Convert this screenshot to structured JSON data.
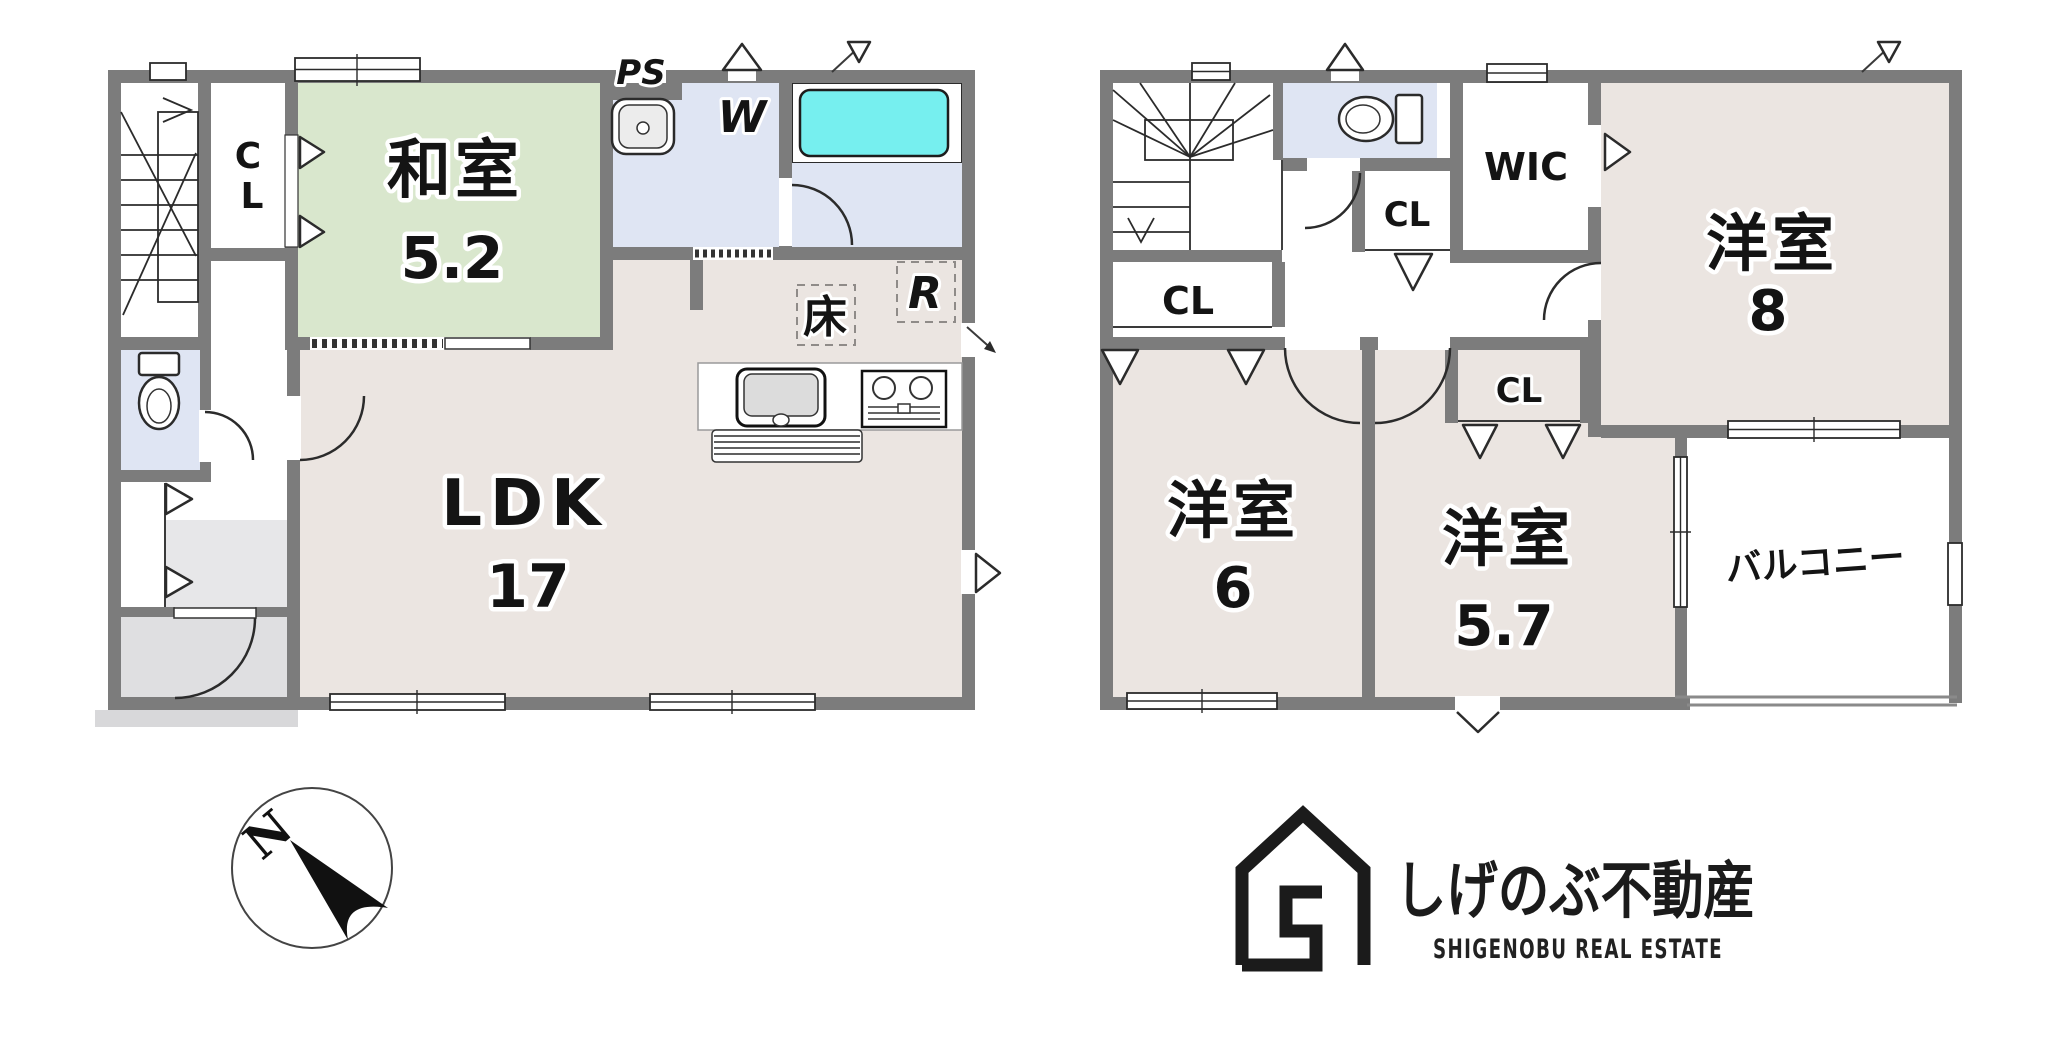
{
  "floor1": {
    "closet_top_line1": "C",
    "closet_top_line2": "L",
    "washitsu": {
      "name": "和室",
      "size": "5.2"
    },
    "ps": "PS",
    "washer": "W",
    "underfloor_storage": "床",
    "refrigerator": "R",
    "ldk": {
      "name": "LDK",
      "size": "17"
    }
  },
  "floor2": {
    "closet_by_stairs": "CL",
    "closet_hall": "CL",
    "wic": "WIC",
    "closet_room57": "CL",
    "room8": {
      "name": "洋室",
      "size": "8"
    },
    "room6": {
      "name": "洋室",
      "size": "6"
    },
    "room57": {
      "name": "洋室",
      "size": "5.7"
    },
    "balcony": "バルコニー"
  },
  "compass": {
    "north": "N"
  },
  "logo": {
    "company_jp": "しげのぶ不動産",
    "company_en": "SHIGENOBU REAL ESTATE"
  },
  "colors": {
    "wall_gray": "#7c7c7c",
    "tatami_green": "#d9e7cd",
    "floor_beige": "#ebe5e1",
    "water_blue": "#dfe5f3",
    "bathtub_cyan": "#76efef",
    "entry_gray": "#e7e7e9",
    "genkan_gray": "#dfdfe1",
    "porch_gray": "#d8d8da",
    "logo_ink": "#1b1b1b"
  }
}
